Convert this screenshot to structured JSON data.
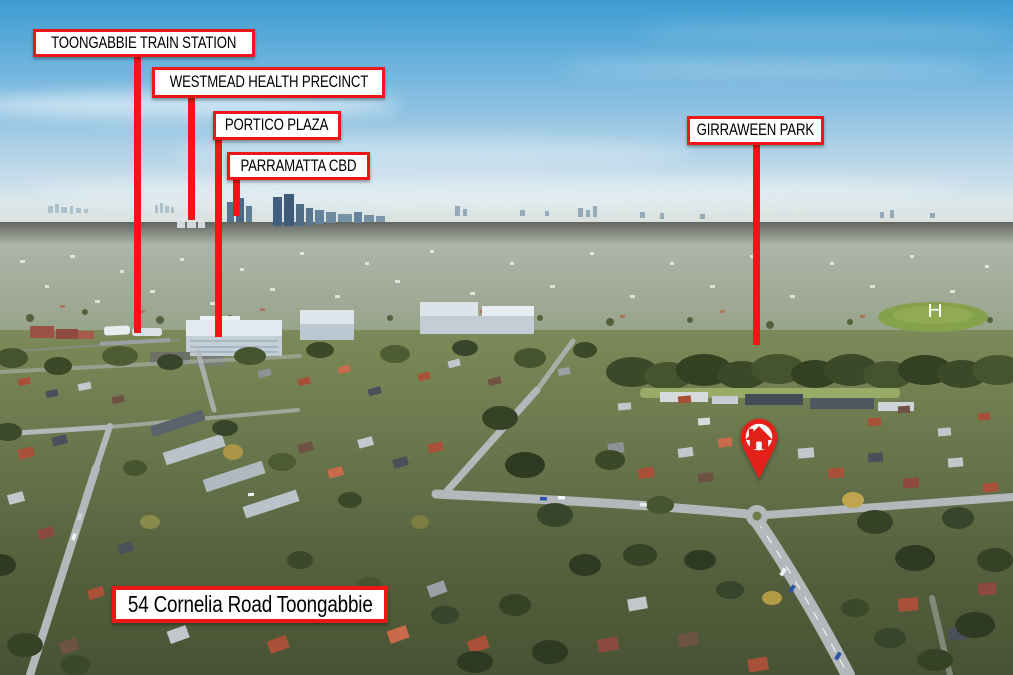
{
  "callouts": {
    "train_station": "TOONGABBIE TRAIN STATION",
    "health_precinct": "WESTMEAD HEALTH PRECINCT",
    "portico_plaza": "PORTICO PLAZA",
    "parramatta_cbd": "PARRAMATTA CBD",
    "girraween_park": "GIRRAWEEN PARK",
    "property_address": "54 Cornelia Road Toongabbie"
  },
  "map_pin": {
    "icon_name": "house-icon"
  },
  "colors": {
    "annotation_red": "#ee1616",
    "label_background": "#ffffff",
    "label_text": "#000000"
  }
}
